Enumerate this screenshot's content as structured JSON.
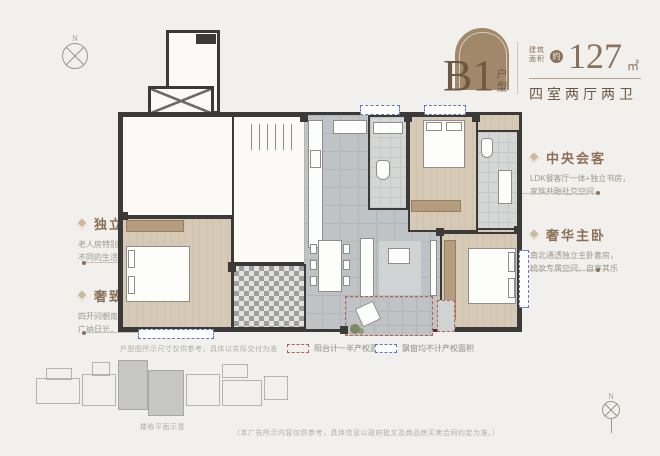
{
  "header": {
    "plan_code": "B1",
    "plan_code_suffix": "户型",
    "area_label_line1": "建筑",
    "area_label_line2": "面积",
    "area_approx": "约",
    "area_value": "127",
    "area_unit": "㎡",
    "layout_desc": "四室两厅两卫"
  },
  "annotations": {
    "left": [
      {
        "title": "独立卧房",
        "desc1": "老人房特别设计独立空间，",
        "desc2": "不同的生活作息互不干扰"
      },
      {
        "title": "奢致光庭",
        "desc1": "四开间朝南设计，",
        "desc2": "广纳日光，清风徐来"
      }
    ],
    "right": [
      {
        "title": "中央会客",
        "desc1": "LDK餐客厅一体+独立书房，",
        "desc2": "家族共融社交空间"
      },
      {
        "title": "奢华主卧",
        "desc1": "南北通透独立主卧套房，",
        "desc2": "梳妆专属空间，自享其乐"
      }
    ]
  },
  "legend": {
    "balcony_label": "阳台计一半产权面积",
    "baywindow_label": "飘窗均不计产权面积"
  },
  "notes": {
    "plan_note": "户型图所示尺寸仅供参考，具体以实际交付为准",
    "siteplan_caption": "楼栋平面示意",
    "disclaimer": "（本广告所示内容仅供参考，具体信息以政府批文及商品房买卖合同约定为准。）"
  },
  "compass": {
    "north": "N"
  },
  "colors": {
    "brand_brown": "#8a7158",
    "arch_brown": "#a1886a",
    "wall": "#3b3a38",
    "balcony_dash": "#c25b52",
    "baywindow_dash": "#5b79c2"
  }
}
